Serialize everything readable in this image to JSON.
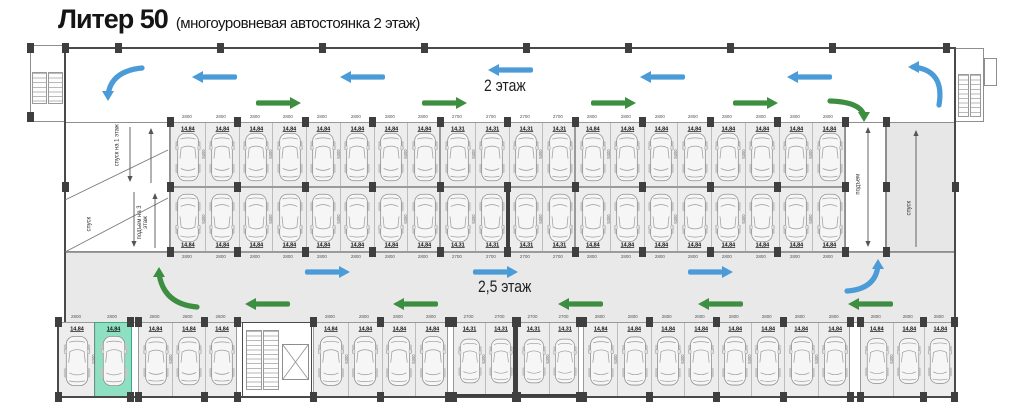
{
  "title": {
    "main": "Литер 50",
    "sub": "(многоуровневая автостоянка 2 этаж)"
  },
  "labels": {
    "floor2": "2 этаж",
    "floor25": "2,5 этаж",
    "ramp_down_1": "спуск на 1 этаж",
    "ramp_up_3": "подъем на 3 этаж",
    "ramp_down": "спуск",
    "ramp_up": "подъем"
  },
  "dimensions": {
    "depth": "5300",
    "w2800": "2800",
    "w2700": "2700"
  },
  "areas": {
    "w2800": "14,84",
    "w2700": "14,31"
  },
  "rows": {
    "upper": [
      {
        "count": 8,
        "size": "w2800"
      },
      {
        "count": 4,
        "size": "w2700"
      },
      {
        "count": 8,
        "size": "w2800"
      }
    ],
    "lower": [
      {
        "count": 8,
        "size": "w2800"
      },
      {
        "count": 4,
        "size": "w2700"
      },
      {
        "count": 8,
        "size": "w2800"
      }
    ],
    "bottom": [
      {
        "count": 2,
        "size": "w2800"
      },
      {
        "count": 3,
        "size": "w2800"
      },
      {
        "count": 4,
        "size": "w2800"
      },
      {
        "count": 2,
        "size": "w2700"
      },
      {
        "count": 2,
        "size": "w2700"
      },
      {
        "count": 8,
        "size": "w2800"
      },
      {
        "count": 3,
        "size": "w2800"
      }
    ]
  },
  "highlight": {
    "row": "bottom",
    "group": 0,
    "index": 1
  },
  "colors": {
    "arrow_blue": "#4a9bd8",
    "arrow_green": "#3e8e41",
    "highlight": "#8fe0c2",
    "corridor": "#e9e9e9",
    "space_fill": "#ededed",
    "column": "#3f3f3f"
  }
}
